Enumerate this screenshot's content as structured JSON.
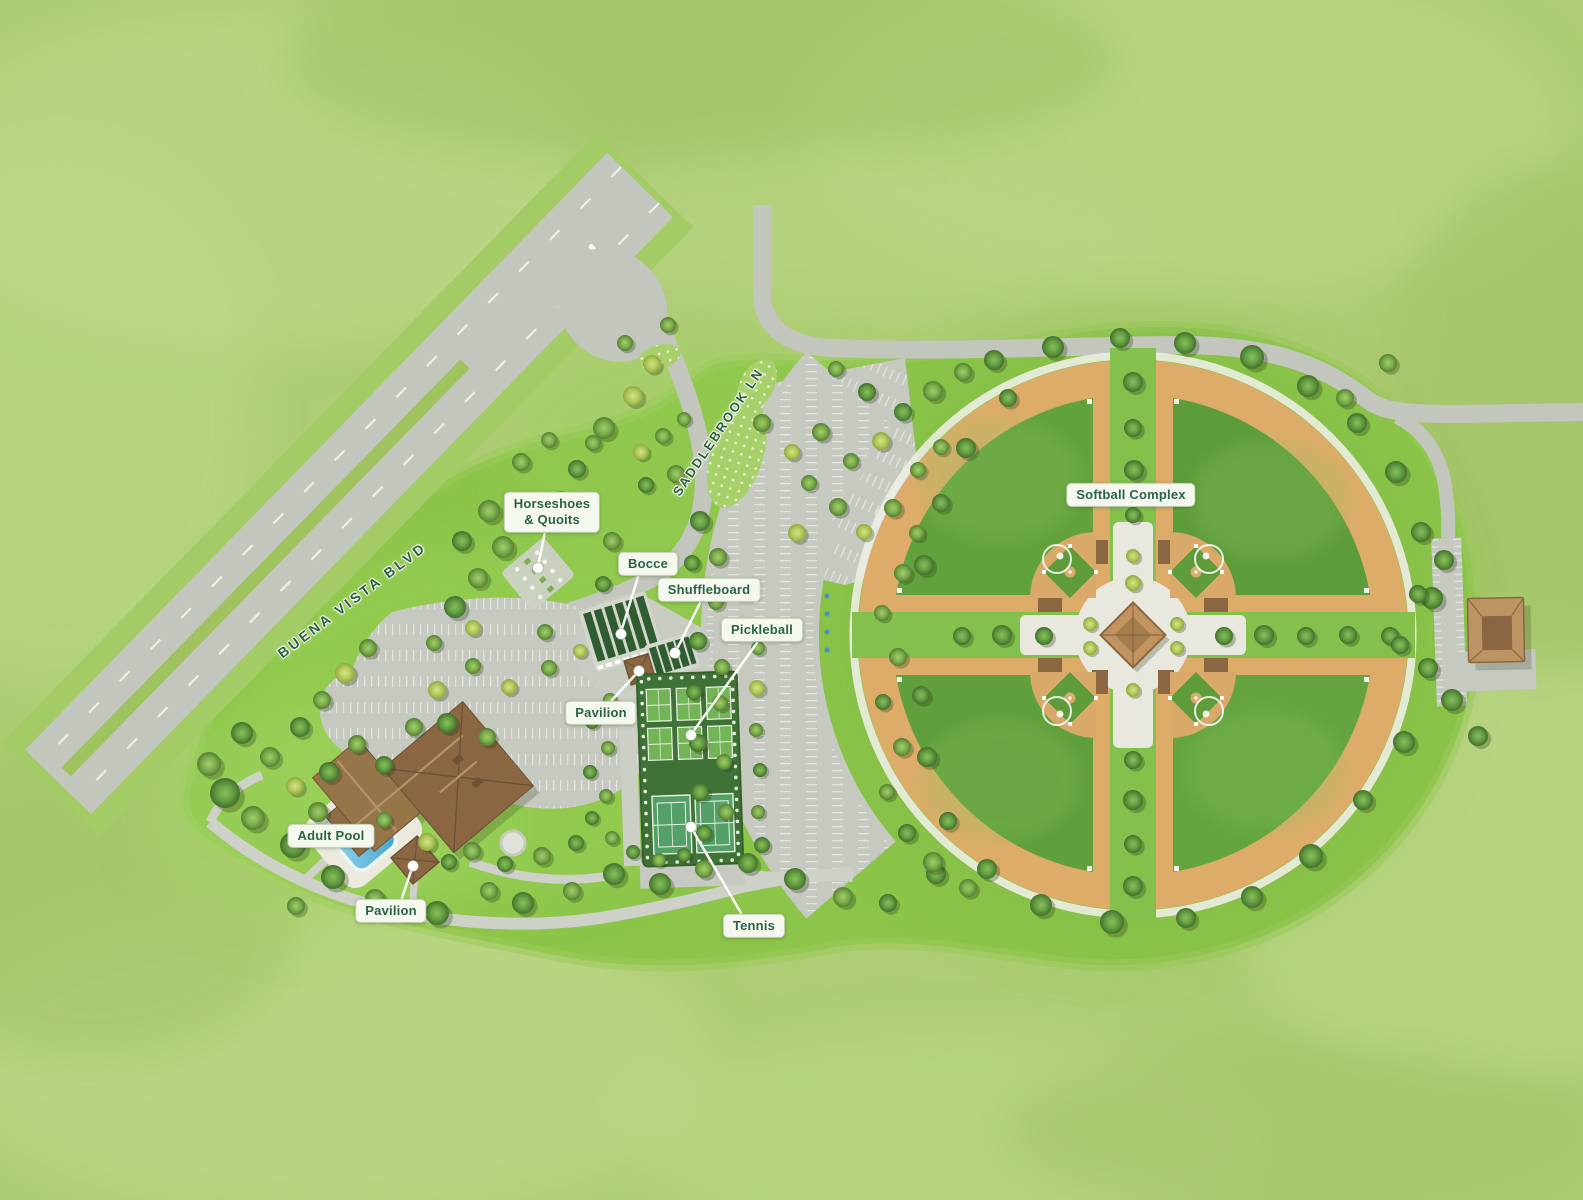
{
  "map": {
    "name": "Recreation area illustrated site map",
    "type": "illustrated-site-plan"
  },
  "theme": {
    "bg": "#aecd74",
    "park": "#8cc549",
    "park_deep": "#62a23d",
    "road": "#c3c6bd",
    "path": "#cdd1c7",
    "tan": "#ddac69",
    "court_dark": "#3f7236",
    "court_light": "#73b457",
    "tennis_green": "#55a068",
    "pool_blue": "#5fbede",
    "roof_brown": "#8a6742",
    "white_path": "#ecefe3",
    "label_bg": "#f5f8ef",
    "label_text": "#2b6348"
  },
  "streets": [
    {
      "name": "BUENA VISTA BLVD",
      "angle_deg": -37
    },
    {
      "name": "SADDLEBROOK LN",
      "angle_deg": -56
    }
  ],
  "labels": [
    {
      "id": "horseshoes",
      "text": "Horseshoes\n& Quoits"
    },
    {
      "id": "bocce",
      "text": "Bocce"
    },
    {
      "id": "shuffleboard",
      "text": "Shuffleboard"
    },
    {
      "id": "pickleball",
      "text": "Pickleball"
    },
    {
      "id": "pavilion-upper",
      "text": "Pavilion"
    },
    {
      "id": "adult-pool",
      "text": "Adult Pool"
    },
    {
      "id": "pavilion-lower",
      "text": "Pavilion"
    },
    {
      "id": "tennis",
      "text": "Tennis"
    },
    {
      "id": "softball",
      "text": "Softball Complex"
    }
  ]
}
